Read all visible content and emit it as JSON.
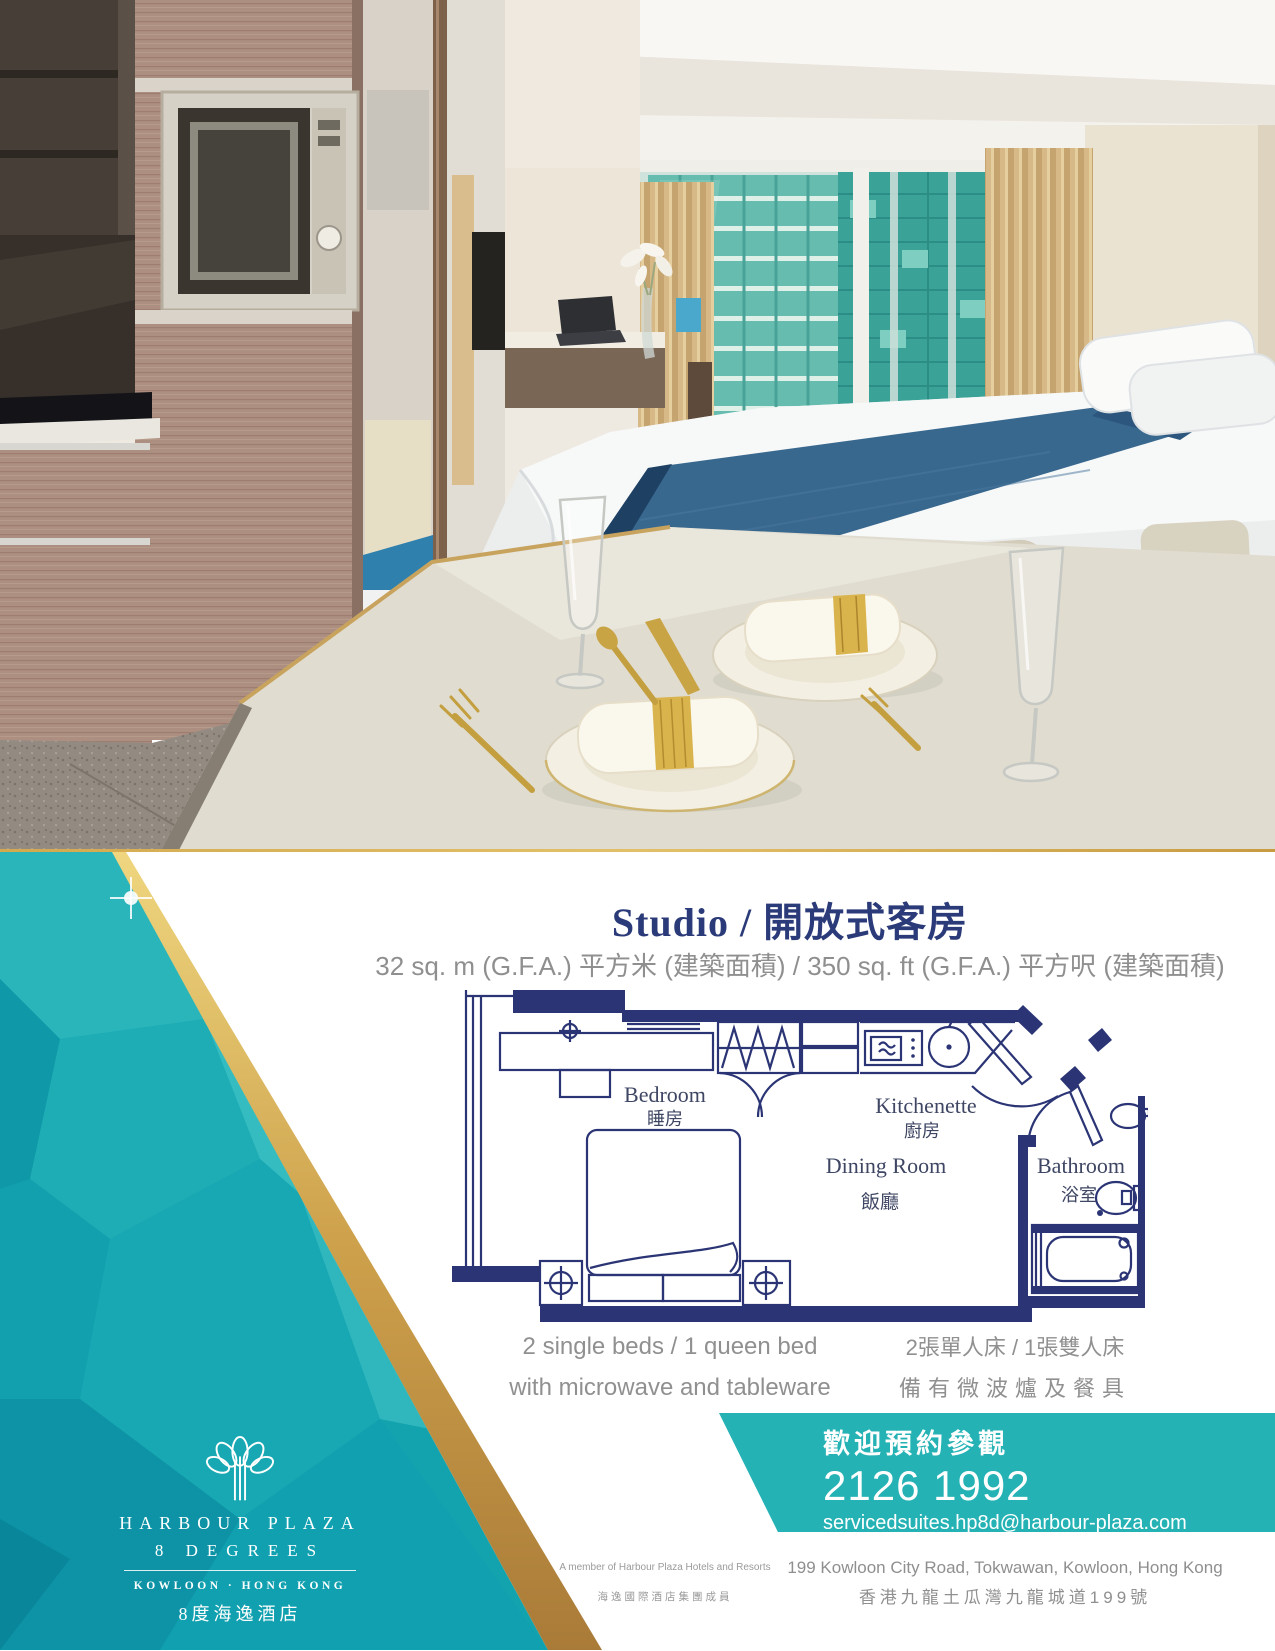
{
  "title": "Studio / 開放式客房",
  "subtitle": "32 sq. m (G.F.A.) 平方米 (建築面積) / 350 sq. ft (G.F.A.) 平方呎 (建築面積)",
  "floorplan": {
    "bedroom_en": "Bedroom",
    "bedroom_zh": "睡房",
    "kitchenette_en": "Kitchenette",
    "kitchenette_zh": "廚房",
    "dining_en": "Dining Room",
    "dining_zh": "飯廳",
    "bathroom_en": "Bathroom",
    "bathroom_zh": "浴室"
  },
  "features": {
    "en_line1": "2 single beds / 1 queen bed",
    "en_line2": "with microwave and tableware",
    "zh_line1": "2張單人床 / 1張雙人床",
    "zh_line2": "備有微波爐及餐具"
  },
  "contact": {
    "heading_zh": "歡迎預約參觀",
    "phone": "2126 1992",
    "email": "servicedsuites.hp8d@harbour-plaza.com"
  },
  "logo": {
    "name_line1": "HARBOUR PLAZA",
    "name_line2": "8 DEGREES",
    "location": "KOWLOON · HONG KONG",
    "name_zh": "8度海逸酒店"
  },
  "member": {
    "en": "A member of Harbour Plaza Hotels and Resorts",
    "zh": "海逸國際酒店集團成員"
  },
  "address": {
    "en": "199 Kowloon City Road, Tokwawan, Kowloon, Hong Kong",
    "zh": "香港九龍土瓜灣九龍城道199號"
  },
  "colors": {
    "navy": "#2b3575",
    "teal": "#17a9b4",
    "teal_box": "#25b2b5",
    "gold": "#c9973f",
    "text_gray": "#8f8f8f"
  }
}
